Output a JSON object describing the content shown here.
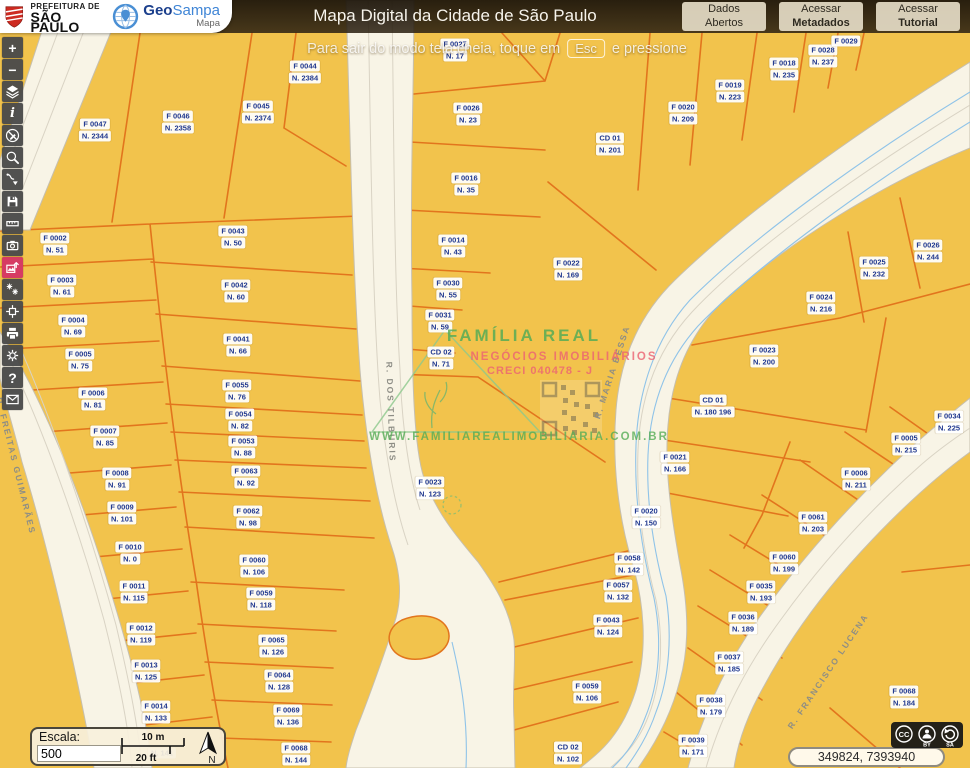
{
  "header": {
    "prefeitura_line1": "PREFEITURA DE",
    "prefeitura_line2": "SÃO PAULO",
    "brand_geo": "Geo",
    "brand_sampa": "Sampa",
    "brand_mapa": "Mapa",
    "title": "Mapa Digital da Cidade de São Paulo",
    "buttons": [
      {
        "line1": "Dados",
        "line2": "Abertos",
        "bold2": false
      },
      {
        "line1": "Acessar",
        "line2": "Metadados",
        "bold2": true
      },
      {
        "line1": "Acessar",
        "line2": "Tutorial",
        "bold2": true
      }
    ]
  },
  "toast": {
    "text_before": "Para sair do modo tela cheia, toque em",
    "key": "Esc",
    "text_after": "e pressione"
  },
  "toolbar": {
    "tools": [
      {
        "name": "zoom-in"
      },
      {
        "name": "zoom-out"
      },
      {
        "name": "layers"
      },
      {
        "name": "identify"
      },
      {
        "name": "disable-drawing"
      },
      {
        "name": "search"
      },
      {
        "name": "import-route"
      },
      {
        "name": "save"
      },
      {
        "name": "measure"
      },
      {
        "name": "street-photos"
      },
      {
        "name": "export-image",
        "active": true
      },
      {
        "name": "vegetation"
      },
      {
        "name": "center-map"
      },
      {
        "name": "print"
      },
      {
        "name": "settings"
      },
      {
        "name": "help"
      },
      {
        "name": "contact"
      }
    ]
  },
  "map": {
    "watermark": {
      "title": "FAMÍLIA REAL",
      "subtitle": "NEGÓCIOS IMOBILIÁRIOS",
      "creci": "CRECI 040478 - J",
      "url": "WWW.FAMILIAREALIMOBILIARIA.COM.BR"
    },
    "street_labels": [
      {
        "text": "R. FREITAS GUIMARÃES",
        "x": 16,
        "y": 466,
        "rot": 76
      },
      {
        "text": "R. DOS TILBURIS",
        "x": 391,
        "y": 412,
        "rot": 88
      },
      {
        "text": "R. MARIA BESSA",
        "x": 612,
        "y": 372,
        "rot": -72
      },
      {
        "text": "R. FRANCISCO LUCENA",
        "x": 828,
        "y": 671,
        "rot": -56
      }
    ],
    "parcel_labels": [
      {
        "code": "F 0047",
        "num": "N. 2344",
        "x": 95,
        "y": 130
      },
      {
        "code": "F 0046",
        "num": "N. 2358",
        "x": 178,
        "y": 122
      },
      {
        "code": "F 0045",
        "num": "N. 2374",
        "x": 258,
        "y": 112
      },
      {
        "code": "F 0044",
        "num": "N. 2384",
        "x": 305,
        "y": 72
      },
      {
        "code": "F 0002",
        "num": "N. 51",
        "x": 55,
        "y": 244
      },
      {
        "code": "F 0043",
        "num": "N. 50",
        "x": 233,
        "y": 237
      },
      {
        "code": "F 0003",
        "num": "N. 61",
        "x": 62,
        "y": 286
      },
      {
        "code": "F 0042",
        "num": "N. 60",
        "x": 236,
        "y": 291
      },
      {
        "code": "F 0004",
        "num": "N. 69",
        "x": 73,
        "y": 326
      },
      {
        "code": "F 0041",
        "num": "N. 66",
        "x": 238,
        "y": 345
      },
      {
        "code": "F 0005",
        "num": "N. 75",
        "x": 80,
        "y": 360
      },
      {
        "code": "F 0055",
        "num": "N. 76",
        "x": 237,
        "y": 391
      },
      {
        "code": "F 0006",
        "num": "N. 81",
        "x": 93,
        "y": 399
      },
      {
        "code": "F 0054",
        "num": "N. 82",
        "x": 240,
        "y": 420
      },
      {
        "code": "F 0053",
        "num": "N. 88",
        "x": 243,
        "y": 447
      },
      {
        "code": "F 0007",
        "num": "N. 85",
        "x": 105,
        "y": 437
      },
      {
        "code": "F 0063",
        "num": "N. 92",
        "x": 246,
        "y": 477
      },
      {
        "code": "F 0008",
        "num": "N. 91",
        "x": 117,
        "y": 479
      },
      {
        "code": "F 0009",
        "num": "N. 101",
        "x": 122,
        "y": 513
      },
      {
        "code": "F 0062",
        "num": "N. 98",
        "x": 248,
        "y": 517
      },
      {
        "code": "F 0010",
        "num": "N. 0",
        "x": 130,
        "y": 553
      },
      {
        "code": "F 0060",
        "num": "N. 106",
        "x": 254,
        "y": 566
      },
      {
        "code": "F 0011",
        "num": "N. 115",
        "x": 134,
        "y": 592
      },
      {
        "code": "F 0059",
        "num": "N. 118",
        "x": 261,
        "y": 599
      },
      {
        "code": "F 0012",
        "num": "N. 119",
        "x": 141,
        "y": 634
      },
      {
        "code": "F 0065",
        "num": "N. 126",
        "x": 273,
        "y": 646
      },
      {
        "code": "F 0013",
        "num": "N. 125",
        "x": 146,
        "y": 671
      },
      {
        "code": "F 0064",
        "num": "N. 128",
        "x": 279,
        "y": 681
      },
      {
        "code": "F 0014",
        "num": "N. 133",
        "x": 156,
        "y": 712
      },
      {
        "code": "F 0069",
        "num": "N. 136",
        "x": 288,
        "y": 716
      },
      {
        "code": "F 0068",
        "num": "N. 144",
        "x": 296,
        "y": 754
      },
      {
        "code": "F 0027",
        "num": "N. 17",
        "x": 455,
        "y": 50
      },
      {
        "code": "F 0026",
        "num": "N. 23",
        "x": 468,
        "y": 114
      },
      {
        "code": "F 0016",
        "num": "N. 35",
        "x": 466,
        "y": 184
      },
      {
        "code": "F 0014",
        "num": "N. 43",
        "x": 453,
        "y": 246
      },
      {
        "code": "F 0030",
        "num": "N. 55",
        "x": 448,
        "y": 289
      },
      {
        "code": "F 0031",
        "num": "N. 59",
        "x": 440,
        "y": 321
      },
      {
        "code": "CD 02",
        "num": "N. 71",
        "x": 441,
        "y": 358
      },
      {
        "code": "F 0023",
        "num": "N. 123",
        "x": 430,
        "y": 488
      },
      {
        "code": "F 0022",
        "num": "N. 169",
        "x": 568,
        "y": 269
      },
      {
        "code": "CD 01",
        "num": "N. 201",
        "x": 610,
        "y": 144
      },
      {
        "code": "F 0020",
        "num": "N. 209",
        "x": 683,
        "y": 113
      },
      {
        "code": "F 0019",
        "num": "N. 223",
        "x": 730,
        "y": 91
      },
      {
        "code": "F 0018",
        "num": "N. 235",
        "x": 784,
        "y": 69
      },
      {
        "code": "F 0028",
        "num": "N. 237",
        "x": 823,
        "y": 56
      },
      {
        "code": "F 0029",
        "num": "",
        "x": 846,
        "y": 41
      },
      {
        "code": "F 0026",
        "num": "N. 244",
        "x": 928,
        "y": 251
      },
      {
        "code": "F 0025",
        "num": "N. 232",
        "x": 874,
        "y": 268
      },
      {
        "code": "F 0024",
        "num": "N. 216",
        "x": 821,
        "y": 303
      },
      {
        "code": "F 0023",
        "num": "N. 200",
        "x": 764,
        "y": 356
      },
      {
        "code": "CD 01",
        "num": "N. 180 196",
        "x": 713,
        "y": 406
      },
      {
        "code": "F 0021",
        "num": "N. 166",
        "x": 675,
        "y": 463
      },
      {
        "code": "F 0020",
        "num": "N. 150",
        "x": 646,
        "y": 517
      },
      {
        "code": "F 0058",
        "num": "N. 142",
        "x": 629,
        "y": 564
      },
      {
        "code": "F 0057",
        "num": "N. 132",
        "x": 618,
        "y": 591
      },
      {
        "code": "F 0043",
        "num": "N. 124",
        "x": 608,
        "y": 626
      },
      {
        "code": "F 0059",
        "num": "N. 106",
        "x": 587,
        "y": 692
      },
      {
        "code": "CD 02",
        "num": "N. 102",
        "x": 568,
        "y": 753
      },
      {
        "code": "F 0034",
        "num": "N. 225",
        "x": 949,
        "y": 422
      },
      {
        "code": "F 0005",
        "num": "N. 215",
        "x": 906,
        "y": 444
      },
      {
        "code": "F 0006",
        "num": "N. 211",
        "x": 856,
        "y": 479
      },
      {
        "code": "F 0061",
        "num": "N. 203",
        "x": 813,
        "y": 523
      },
      {
        "code": "F 0060",
        "num": "N. 199",
        "x": 784,
        "y": 563
      },
      {
        "code": "F 0035",
        "num": "N. 193",
        "x": 761,
        "y": 592
      },
      {
        "code": "F 0036",
        "num": "N. 189",
        "x": 743,
        "y": 623
      },
      {
        "code": "F 0037",
        "num": "N. 185",
        "x": 729,
        "y": 663
      },
      {
        "code": "F 0038",
        "num": "N. 179",
        "x": 711,
        "y": 706
      },
      {
        "code": "F 0039",
        "num": "N. 171",
        "x": 693,
        "y": 746
      },
      {
        "code": "F 0068",
        "num": "N. 184",
        "x": 904,
        "y": 697
      },
      {
        "code": "",
        "num": "N. 141",
        "x": 162,
        "y": 753
      }
    ]
  },
  "scale": {
    "label": "Escala:",
    "value": "500",
    "meters": "10 m",
    "feet": "20 ft",
    "north": "N"
  },
  "statusbar": {
    "coordinates": "349824, 7393940"
  },
  "license": {
    "cc": "CC",
    "by": "BY",
    "sa": "SA"
  },
  "colors": {
    "map_bg": "#f2c34c",
    "parcel_line": "#e2751d",
    "road": "#f8f4e6",
    "road_casing": "#c6bfae",
    "stream": "#8fc3e8",
    "label_text": "#20388f",
    "active_tool": "#d63b63",
    "header_bg": "#241a10",
    "accent_green": "#5fae5f",
    "accent_red": "#e86a78"
  }
}
